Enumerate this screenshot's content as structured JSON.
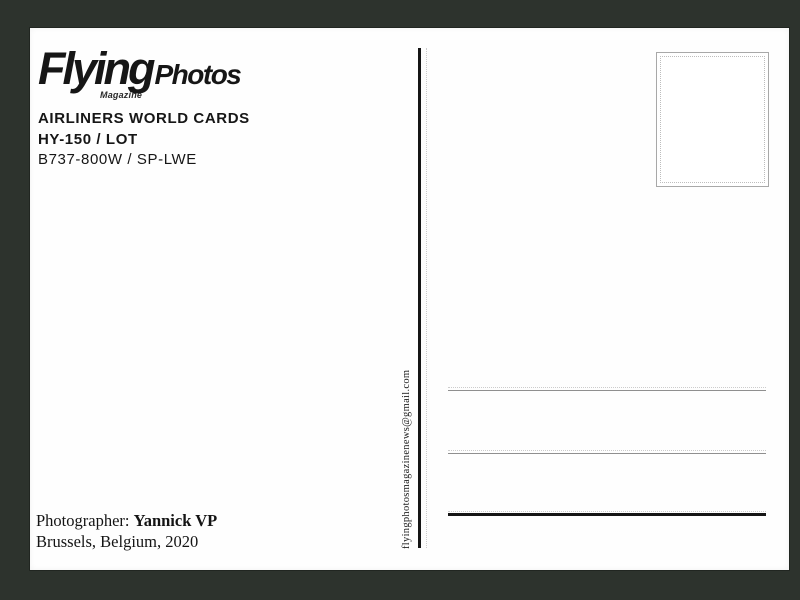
{
  "colors": {
    "frame_bg": "#2d332d",
    "card_bg": "#fefefe",
    "ink": "#161616",
    "line_thin": "#8f8f8f",
    "line_dotted": "#cccccc",
    "line_thick": "#151515",
    "stamp_border": "#a8a8a8",
    "stamp_dotted": "#bdbdbd"
  },
  "logo": {
    "brand": "Flying",
    "brand_suffix": "Photos",
    "sub": "Magazine"
  },
  "header": {
    "series": "AIRLINERS WORLD CARDS",
    "card_number": "HY-150 / LOT",
    "aircraft": "B737-800W / SP-LWE"
  },
  "contact": {
    "email": "flyingphotosmagazinenews@gmail.com"
  },
  "footer": {
    "photographer_label": "Photographer: ",
    "photographer_name": "Yannick VP",
    "location_line": "Brussels, Belgium, 2020"
  }
}
